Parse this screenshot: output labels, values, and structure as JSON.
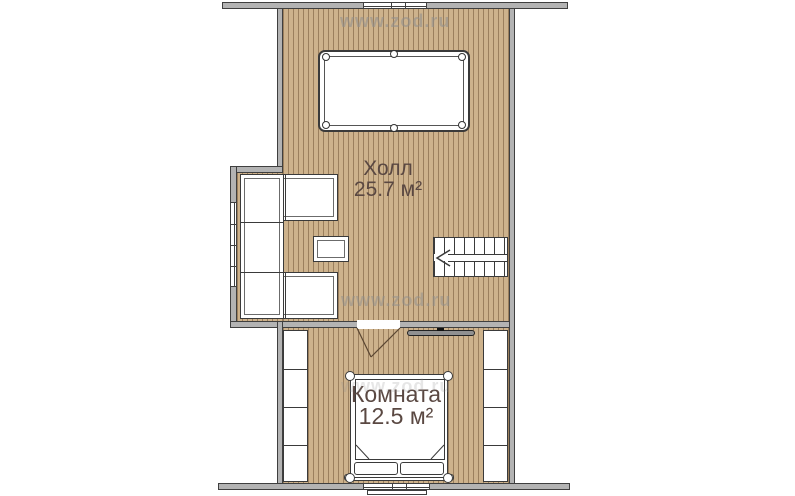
{
  "watermark": {
    "text": "www.zod.ru"
  },
  "rooms": {
    "hall": {
      "name": "Холл",
      "area": "25.7 м²"
    },
    "bedroom": {
      "name": "Комната",
      "area": "12.5 м²"
    }
  },
  "colors": {
    "floor": "#cdb28c",
    "floorLine": "#9b7f5d",
    "wallFill": "#b3b3b3",
    "wallLine": "#3f3f3f",
    "furnLine": "#3a3a3a",
    "label": "#5a4842",
    "watermark": "#8f8f8f"
  }
}
